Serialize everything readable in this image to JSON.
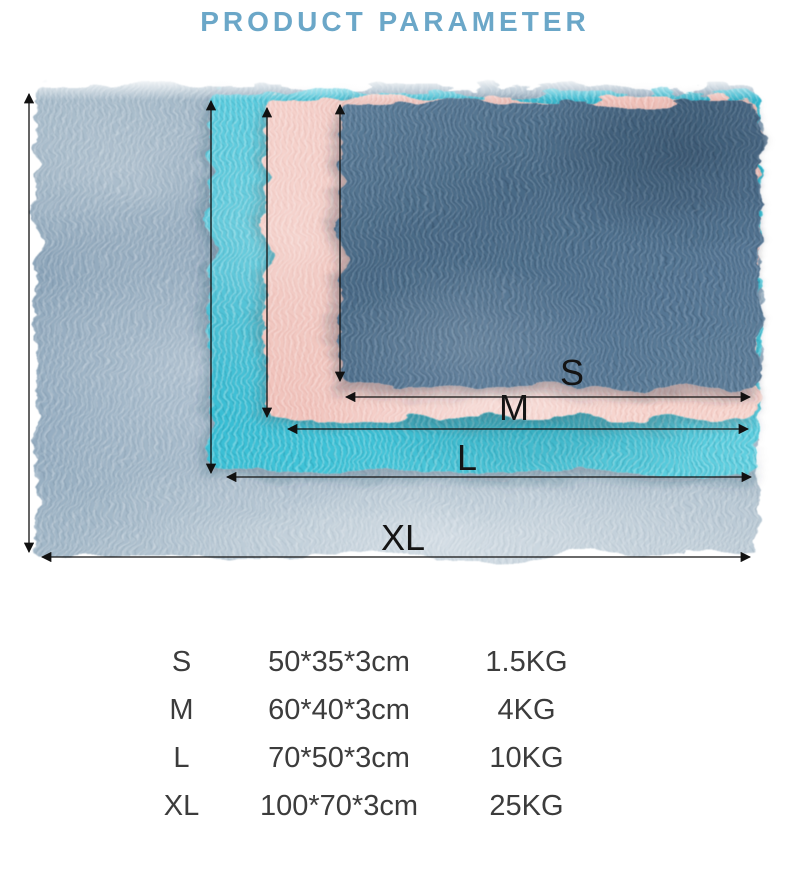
{
  "title": "PRODUCT PARAMETER",
  "theme": {
    "title_color": "#6ba7c8",
    "diagram_label_color": "#141414",
    "table_text_color": "#3c3c3c",
    "mat_colors": {
      "xl_gray": "#92aabe",
      "l_cyan": "#37bfd6",
      "m_pink": "#f1c6c0",
      "s_dark_blue": "#52718e"
    }
  },
  "diagram": {
    "labels": [
      "S",
      "M",
      "L",
      "XL"
    ]
  },
  "table": {
    "rows": [
      {
        "size": "S",
        "dimensions": "50*35*3cm",
        "weight": "1.5KG"
      },
      {
        "size": "M",
        "dimensions": "60*40*3cm",
        "weight": "4KG"
      },
      {
        "size": "L",
        "dimensions": "70*50*3cm",
        "weight": "10KG"
      },
      {
        "size": "XL",
        "dimensions": "100*70*3cm",
        "weight": "25KG"
      }
    ]
  }
}
